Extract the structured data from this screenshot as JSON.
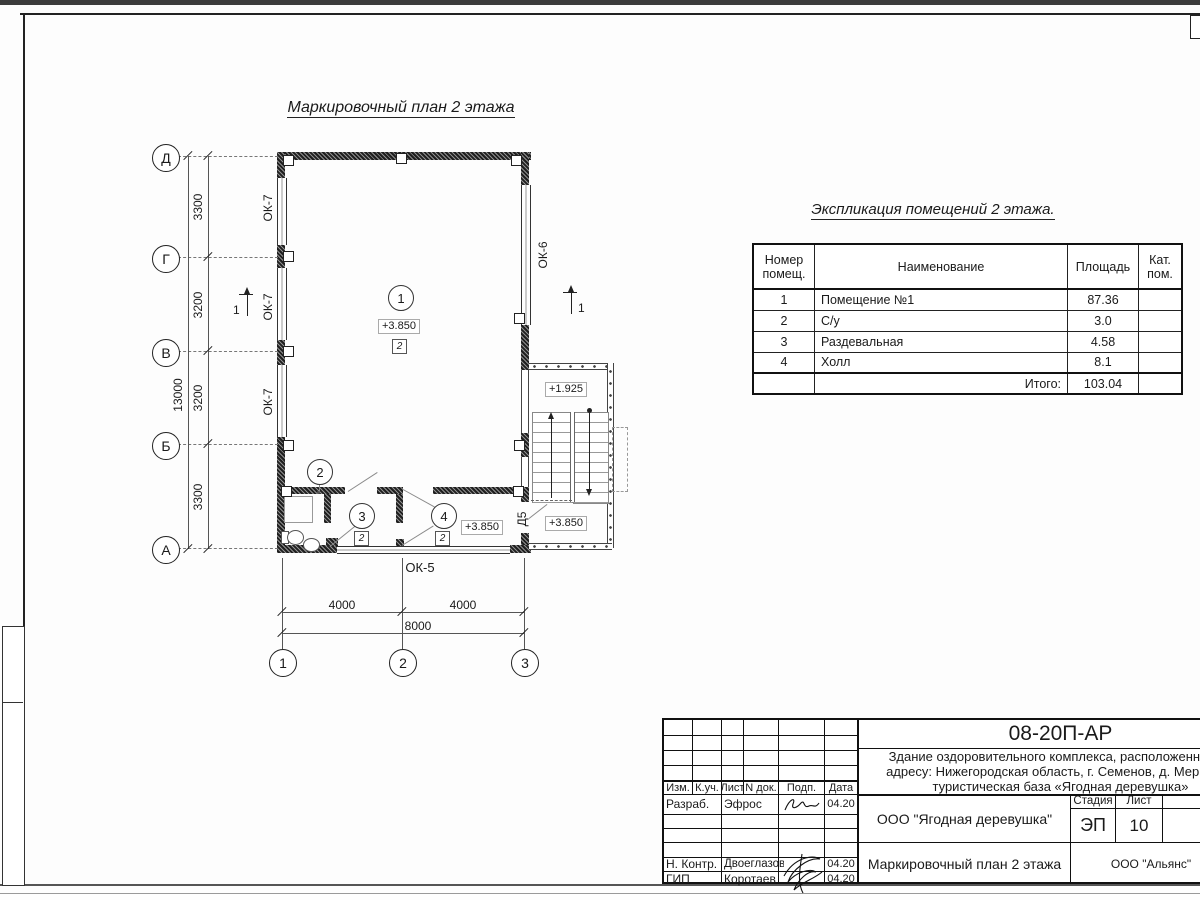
{
  "plan": {
    "title": "Маркировочный план 2 этажа",
    "axes_rows": [
      "Д",
      "Г",
      "В",
      "Б",
      "А"
    ],
    "axes_cols": [
      "1",
      "2",
      "3"
    ],
    "dims_left": [
      "3300",
      "3200",
      "3200",
      "3300"
    ],
    "dim_left_total": "13000",
    "dims_bottom": [
      "4000",
      "4000"
    ],
    "dim_bottom_total": "8000",
    "label_ok7": "ОК-7",
    "label_ok6": "ОК-6",
    "label_ok5": "ОК-5",
    "label_d5": "Д5",
    "section_no": "1",
    "room_nums": [
      "1",
      "2",
      "3",
      "4"
    ],
    "type_mark": "2",
    "elev_main": "+3.850",
    "elev_hall": "+3.850",
    "elev_landing_top": "+1.925",
    "elev_landing_bottom": "+3.850"
  },
  "explication": {
    "title": "Экспликация помещений 2 этажа.",
    "headers": [
      "Номер помещ.",
      "Наименование",
      "Площадь",
      "Кат. пом."
    ],
    "rows": [
      [
        "1",
        "Помещение №1",
        "87.36"
      ],
      [
        "2",
        "С/у",
        "3.0"
      ],
      [
        "3",
        "Раздевальная",
        "4.58"
      ],
      [
        "4",
        "Холл",
        "8.1"
      ]
    ],
    "total_label": "Итого:",
    "total_value": "103.04"
  },
  "titleblock": {
    "doc_number": "08-20П-АР",
    "description_line1": "Здание оздоровительного комплекса, расположенное по",
    "description_line2": "адресу: Нижегородская область, г. Семенов, д. Мериново",
    "description_line3": "туристическая база «Ягодная деревушка»",
    "org": "ООО \"Ягодная деревушка\"",
    "drawing_title": "Маркировочный план 2 этажа",
    "contractor": "ООО \"Альянс\"",
    "stage_header": "Стадия",
    "sheet_header": "Лист",
    "sheets_header": "Листов",
    "stage": "ЭП",
    "sheet_no": "10",
    "cols": [
      "Изм.",
      "К.уч.",
      "Лист",
      "N док.",
      "Подп.",
      "Дата"
    ],
    "sig_rows": [
      {
        "role": "Разраб.",
        "name": "Эфрос",
        "date": "04.20"
      },
      {
        "role": "Н. Контр.",
        "name": "Двоеглазов",
        "date": "04.20"
      },
      {
        "role": "ГИП",
        "name": "Коротаев",
        "date": "04.20"
      }
    ]
  }
}
